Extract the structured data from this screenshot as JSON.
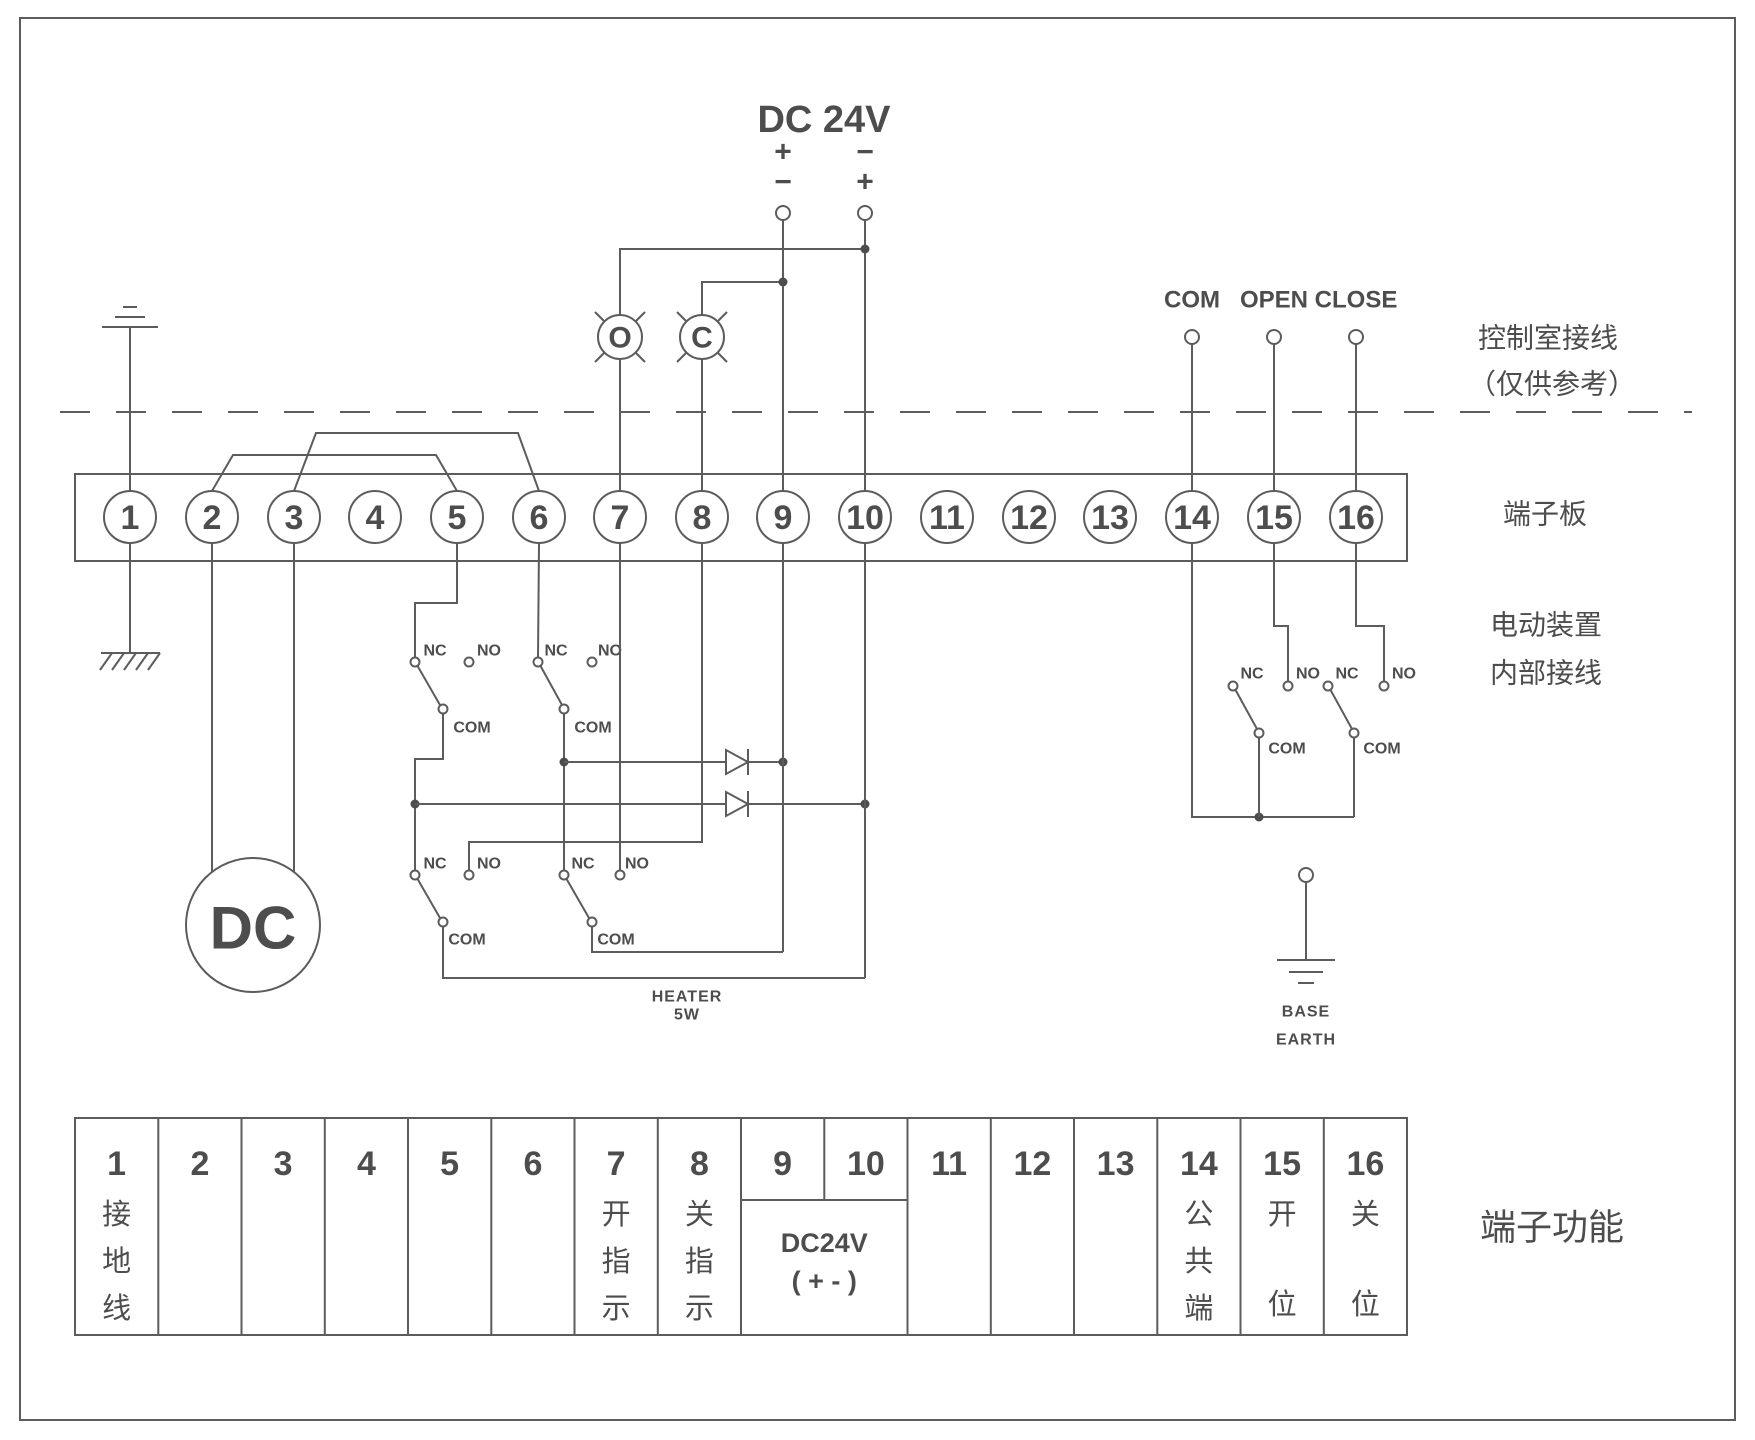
{
  "power": {
    "title": "DC 24V",
    "left_top": "+",
    "left_bottom": "−",
    "right_top": "−",
    "right_bottom": "+"
  },
  "lamps": {
    "open": "O",
    "close": "C"
  },
  "remote": {
    "com": "COM",
    "open": "OPEN",
    "close": "CLOSE"
  },
  "contacts": {
    "nc": "NC",
    "no": "NO",
    "com": "COM"
  },
  "motor": {
    "label": "DC"
  },
  "heater": {
    "line1": "HEATER",
    "line2": "5W"
  },
  "base_earth": {
    "line1": "BASE",
    "line2": "EARTH"
  },
  "annotations": {
    "control_room_1": "控制室接线",
    "control_room_2": "（仅供参考）",
    "terminal_board": "端子板",
    "device_1": "电动装置",
    "device_2": "内部接线",
    "terminal_function": "端子功能"
  },
  "terminals": [
    "1",
    "2",
    "3",
    "4",
    "5",
    "6",
    "7",
    "8",
    "9",
    "10",
    "11",
    "12",
    "13",
    "14",
    "15",
    "16"
  ],
  "table": {
    "columns": [
      {
        "num": "1",
        "func": [
          "接",
          "地",
          "线"
        ]
      },
      {
        "num": "2",
        "func": []
      },
      {
        "num": "3",
        "func": []
      },
      {
        "num": "4",
        "func": []
      },
      {
        "num": "5",
        "func": []
      },
      {
        "num": "6",
        "func": []
      },
      {
        "num": "7",
        "func": [
          "开",
          "指",
          "示"
        ]
      },
      {
        "num": "8",
        "func": [
          "关",
          "指",
          "示"
        ]
      },
      {
        "num": "9",
        "func": []
      },
      {
        "num": "10",
        "func": []
      },
      {
        "num": "11",
        "func": []
      },
      {
        "num": "12",
        "func": []
      },
      {
        "num": "13",
        "func": []
      },
      {
        "num": "14",
        "func": [
          "公",
          "共",
          "端"
        ]
      },
      {
        "num": "15",
        "func": [
          "开",
          "位"
        ]
      },
      {
        "num": "16",
        "func": [
          "关",
          "位"
        ]
      }
    ],
    "merged_9_10": {
      "line1": "DC24V",
      "line2": "( + - )"
    }
  },
  "colors": {
    "line": "#5c5c5c",
    "text": "#4d4d4d",
    "background": "#ffffff"
  }
}
